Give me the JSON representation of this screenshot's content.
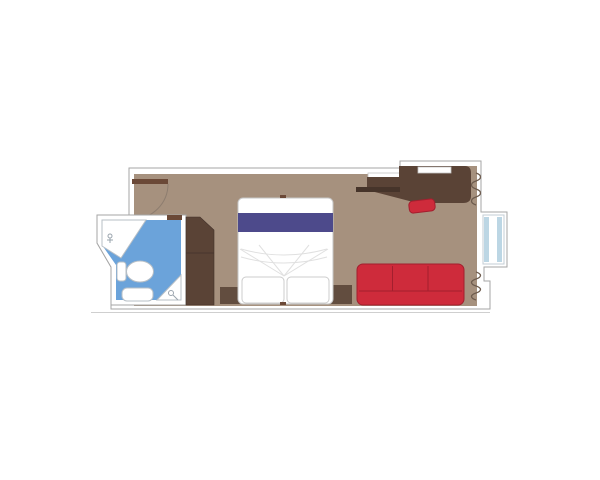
{
  "diagram": {
    "type": "floor-plan",
    "subject": "cabin-stateroom-top-view",
    "rooms": [
      {
        "id": "main-cabin",
        "floor_color_key": "floor"
      },
      {
        "id": "bathroom",
        "floor_color_key": "bathroom_floor"
      }
    ],
    "furniture": [
      {
        "id": "entrance-door",
        "kind": "door-leaf-with-swing-arc"
      },
      {
        "id": "bathroom-door",
        "kind": "door-leaf"
      },
      {
        "id": "washbasin",
        "kind": "corner-sink-counter"
      },
      {
        "id": "toilet",
        "kind": "toilet-with-tank"
      },
      {
        "id": "shower",
        "kind": "corner-shower"
      },
      {
        "id": "bath-tray",
        "kind": "fixture"
      },
      {
        "id": "wardrobe",
        "kind": "two-door-closet"
      },
      {
        "id": "double-bed",
        "kind": "bed-with-two-pillows"
      },
      {
        "id": "nightstand-left",
        "kind": "bedside-unit"
      },
      {
        "id": "nightstand-right",
        "kind": "bedside-unit"
      },
      {
        "id": "sofa",
        "kind": "three-seat-sofa"
      },
      {
        "id": "stool",
        "kind": "desk-stool"
      },
      {
        "id": "desk",
        "kind": "vanity-desk"
      },
      {
        "id": "shelf",
        "kind": "wall-shelf"
      },
      {
        "id": "mirror",
        "kind": "wall-inset"
      },
      {
        "id": "balcony-window",
        "kind": "glazed-bay"
      },
      {
        "id": "hull-zigzag-top",
        "kind": "wall-structure-symbol"
      },
      {
        "id": "hull-zigzag-bottom",
        "kind": "wall-structure-symbol"
      }
    ]
  },
  "colors": {
    "background": "#ffffff",
    "wall_fill": "#ffffff",
    "wall_stroke": "#a6a6a6",
    "floor": "#a6917e",
    "bathroom_floor": "#6ba3da",
    "fixture_fill": "#ffffff",
    "wood_dark": "#5a4336",
    "wood_door": "#6b4937",
    "wood_shelf": "#46342a",
    "nightstand": "#624d3f",
    "bed_fill": "#ffffff",
    "bed_band": "#4d4a8b",
    "sofa_fill": "#ce2b3b",
    "sofa_stroke": "#a31f2e",
    "window_glass": "#bcd6e4",
    "zigzag": "#6e5c4e"
  }
}
